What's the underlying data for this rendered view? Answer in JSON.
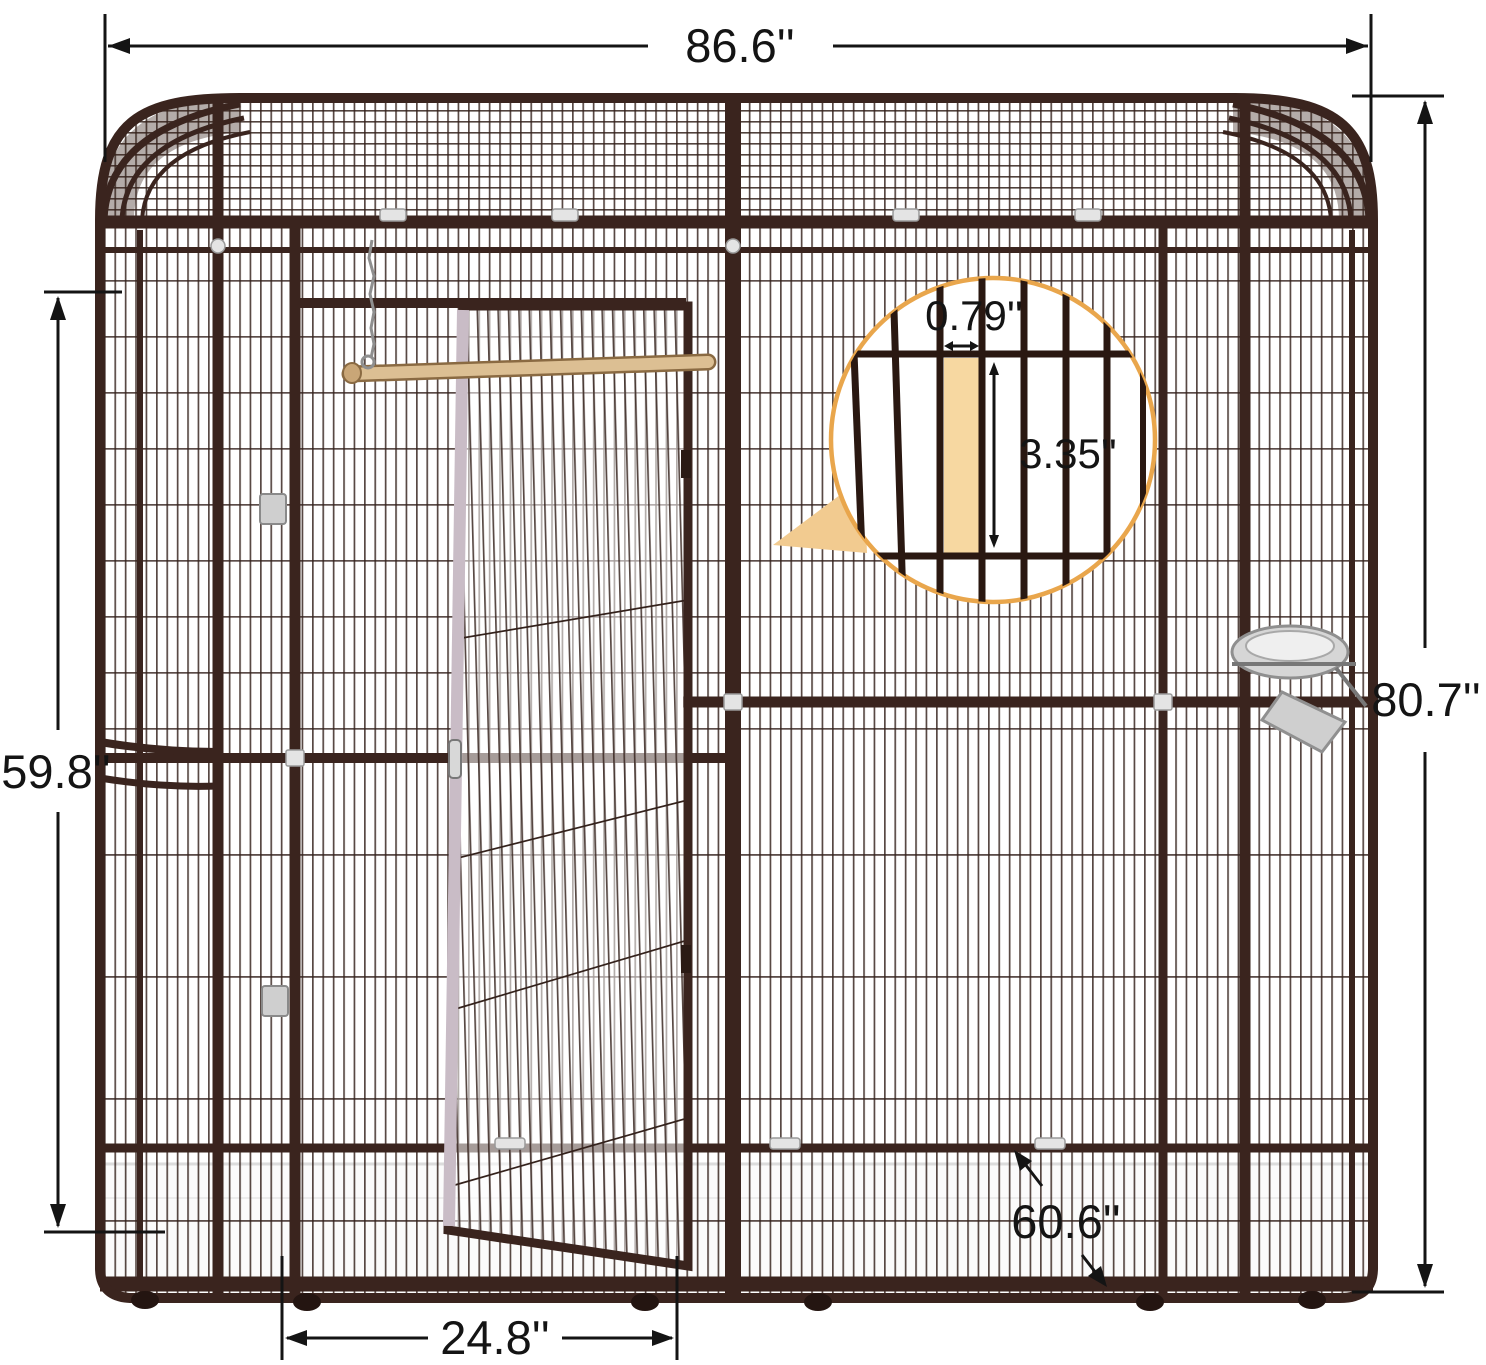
{
  "image": {
    "kind": "product dimension diagram",
    "parts": [
      "wire-mesh-aviary-cage",
      "arched-roof",
      "open-front-door",
      "wooden-perch-with-chain",
      "stainless-feeder-bowl",
      "white-floor-tray",
      "caster-feet",
      "magnifier-inset-circle"
    ]
  },
  "dimensions": {
    "overall_width": "86.6''",
    "overall_height": "80.7''",
    "side_panel_height": "59.8''",
    "door_width": "24.8''",
    "depth": "60.6''",
    "wire_gap_width": "0.79''",
    "wire_gap_height": "3.35''"
  },
  "colors": {
    "frame_brown": "#3a241e",
    "wire_brown": "#33211b",
    "dimension_black": "#141414",
    "inset_circle_border": "#e9a64c",
    "inset_highlight": "#f7d8a1",
    "callout_triangle": "#f2cb90",
    "perch_wood": "#dcbf93",
    "bowl_silver": "#d6d6d6",
    "tray_white": "#fbfbfb"
  }
}
